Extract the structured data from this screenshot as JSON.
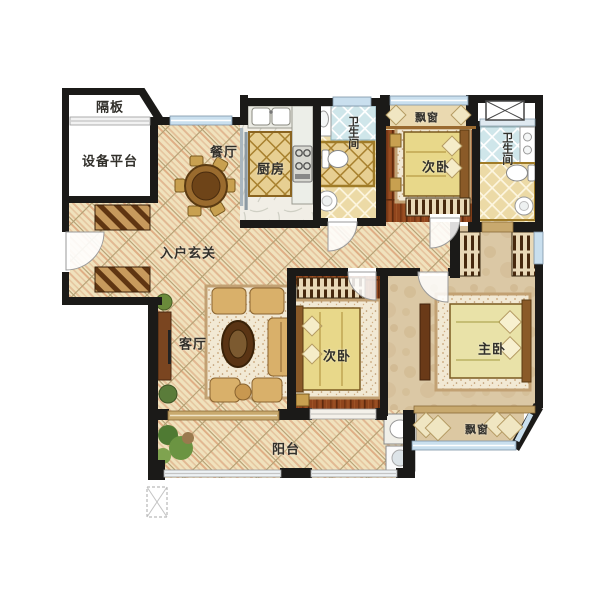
{
  "plan": {
    "title": "residential-floor-plan",
    "rooms": {
      "partition": "隔板",
      "equipment_platform": "设备平台",
      "dining": "餐厅",
      "kitchen": "厨房",
      "bathroom1": "卫生间",
      "bathroom2": "卫生间",
      "bay_window_top": "飘窗",
      "bedroom_top": "次卧",
      "entry_hall": "入户玄关",
      "living_room": "客厅",
      "bedroom_mid": "次卧",
      "master_bedroom": "主卧",
      "balcony": "阳台",
      "bay_window_bottom": "飘窗"
    },
    "colors": {
      "wall": "#1b1a18",
      "tile_floor": "#f0e2bd",
      "wood_floor": "#90451d",
      "master_floor": "#dbc8a5",
      "kitchen_floor": "#f1eee6",
      "bath_blue_tile": "#cfe6ea",
      "bath_cream_tile": "#ecdaa6",
      "window_glass": "#c9dfee",
      "sill_wood": "#c8a96e",
      "gold_trim": "#a8812f",
      "label_text": "#32302b"
    }
  }
}
